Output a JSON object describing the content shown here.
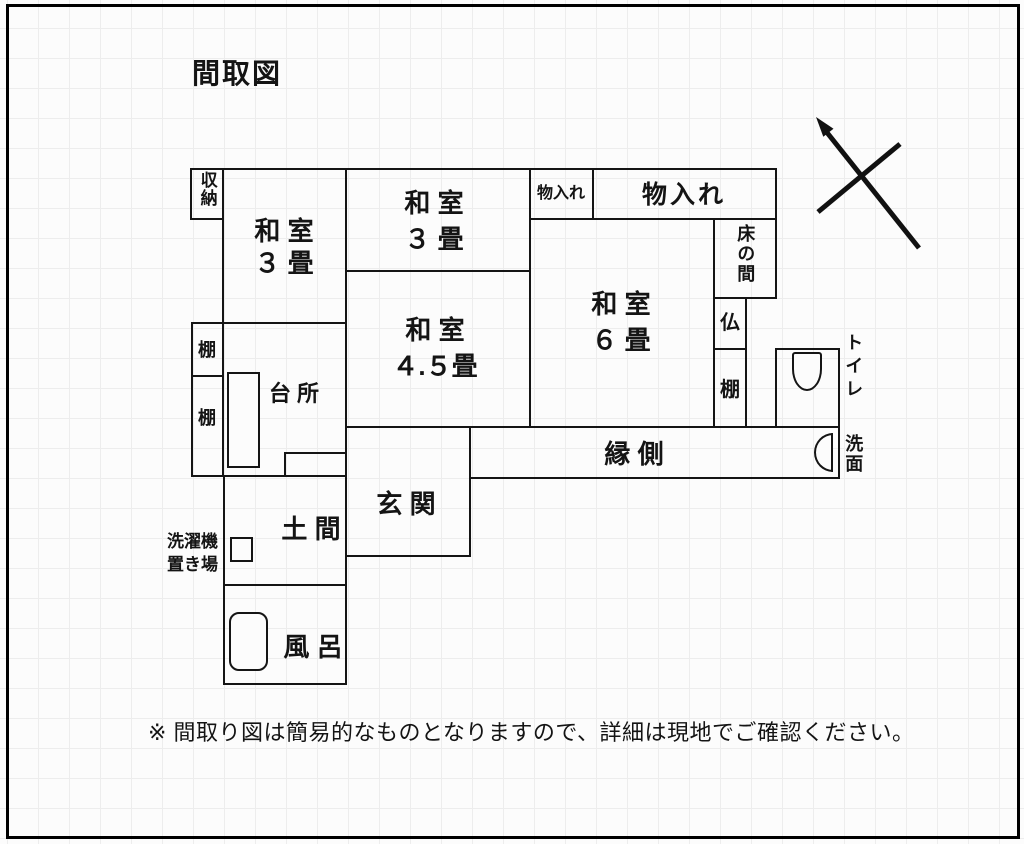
{
  "title": "間取図",
  "footer": "※ 間取り図は簡易的なものとなりますので、詳細は現地でご確認ください。",
  "rooms": {
    "closet": "収納",
    "washitsu3_left": {
      "line1": "和 室",
      "line2": "３ 畳"
    },
    "washitsu3_top": {
      "line1": "和 室",
      "line2": "３ 畳"
    },
    "storage_small": "物入れ",
    "storage_large": "物入れ",
    "tokonoma": "床の間",
    "washitsu6": {
      "line1": "和 室",
      "line2": "６ 畳"
    },
    "butsudan": "仏",
    "shelf_right": "棚",
    "toilet": "トイレ",
    "kitchen": "台 所",
    "washitsu45": {
      "line1": "和 室",
      "line2": "４.５畳"
    },
    "shelf_left_upper": "棚",
    "shelf_left_lower": "棚",
    "engawa": "縁 側",
    "washbasin": "洗面",
    "entrance": "玄 関",
    "doma": "土 間",
    "laundry": {
      "line1": "洗濯機",
      "line2": "置き場"
    },
    "bath": "風 呂"
  },
  "icons": {
    "compass": "north-arrow",
    "toilet": "toilet-bowl",
    "bath": "bathtub",
    "washbasin": "basin",
    "kitchen": "sink",
    "laundry": "washing-machine"
  },
  "colors": {
    "wall": "#151515",
    "background": "#fcfcfc",
    "grid": "#ededed"
  }
}
